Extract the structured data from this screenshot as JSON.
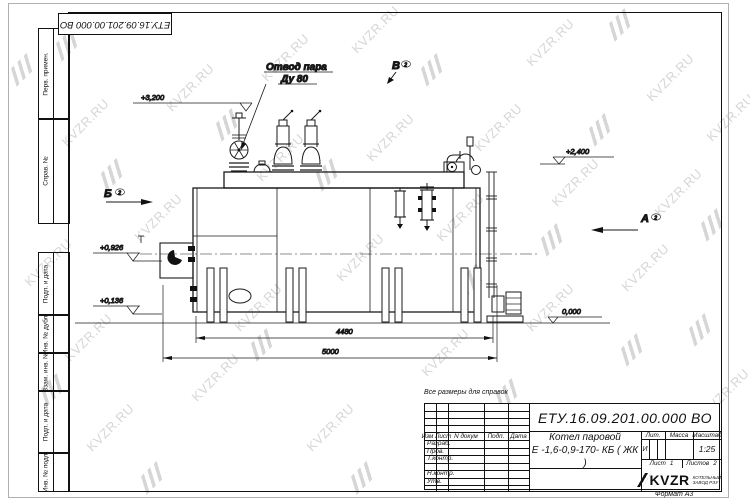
{
  "watermark": {
    "text": "KVZR.RU"
  },
  "frame": {
    "doc_number": "ЕТУ.16.09.201.00.000  ВО",
    "margin_boxes": [
      "Перв. примен.",
      "Справ. №",
      "Подп. и дата",
      "Инв. № дубл.",
      "Взам. инв. №",
      "Подп. и дата",
      "Инв. № подл."
    ]
  },
  "drawing": {
    "note": "Все размеры для справок",
    "callout_line1": "Отвод пара",
    "callout_line2": "Ду 80",
    "elevations": {
      "e3200": "+3,200",
      "e2400": "+2,400",
      "e0926": "+0,926",
      "e0136": "+0,136",
      "e0000": "0,000"
    },
    "sections": {
      "b": "Б",
      "v": "В",
      "a": "А",
      "sheet_ref": "2"
    },
    "dimensions": {
      "d4480": "4480",
      "d5000": "5000"
    }
  },
  "title_block": {
    "doc_number": "ЕТУ.16.09.201.00.000  ВО",
    "title_line1": "Котел паровой",
    "title_line2": "Е -1,6-0,9-170- КБ ( ЖК )",
    "header_cols": {
      "izm": "Изм",
      "list": "Лист",
      "ndoc": "N докум",
      "podp": "Подп.",
      "data": "Дата"
    },
    "rows": [
      "Разраб.",
      "Пров.",
      "Т.контр.",
      "Н.контр.",
      "Утв."
    ],
    "lit_label": "Лит.",
    "mass_label": "Масса",
    "scale_label": "Масштаб",
    "lit_value": "И",
    "scale_value": "1:25",
    "sheet_label": "Лист",
    "sheet_value": "1",
    "sheets_label": "Листов",
    "sheets_value": "2",
    "logo_text": "KVZR",
    "logo_sub1": "КОТЕЛЬНЫЙ",
    "logo_sub2": "ЗАВОД РЭУ",
    "format_label": "Формат  А3"
  }
}
